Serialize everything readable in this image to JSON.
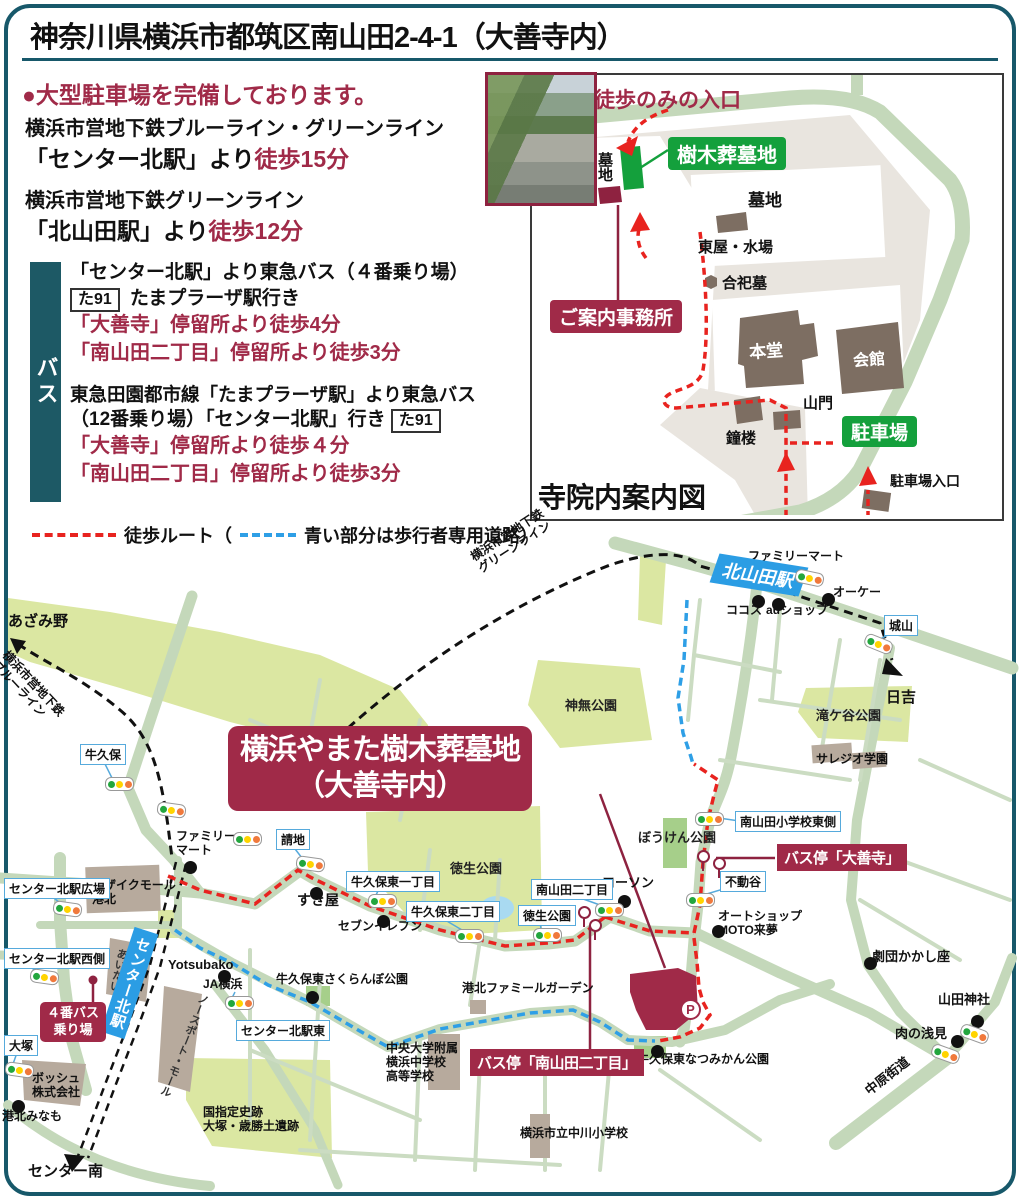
{
  "header": {
    "title": "神奈川県横浜市都筑区南山田2-4-1（大善寺内）"
  },
  "access": {
    "parking_note": "●大型駐車場を完備しております。",
    "subway1_line": "横浜市営地下鉄ブルーライン・グリーンライン",
    "subway1_from": "「センター北駅」より",
    "subway1_walk": "徒歩15分",
    "subway2_line": "横浜市営地下鉄グリーンライン",
    "subway2_from": "「北山田駅」より",
    "subway2_walk": "徒歩12分"
  },
  "bus": {
    "sidebar_label": "バス",
    "route1_line1": "「センター北駅」より東急バス（４番乗り場）",
    "route1_badge": "た91",
    "route1_dest": "たまプラーザ駅行き",
    "route1_stop1": "「大善寺」停留所より徒歩4分",
    "route1_stop2": "「南山田二丁目」停留所より徒歩3分",
    "route2_line1": "東急田園都市線「たまプラーザ駅」より東急バス",
    "route2_line2": "（12番乗り場）「センター北駅」行き",
    "route2_badge": "た91",
    "route2_stop1": "「大善寺」停留所より徒歩４分",
    "route2_stop2": "「南山田二丁目」停留所より徒歩3分"
  },
  "legend": {
    "walk_label": "徒歩ルート（",
    "blue_label": "青い部分は歩行者専用道路）"
  },
  "temple_map": {
    "title": "寺院内案内図",
    "entrance_label": "徒歩のみの入口",
    "tree_grave_badge": "樹木葬墓地",
    "grave_small": "墓地",
    "grave_large": "墓地",
    "azumaya": "東屋・水場",
    "goshibo": "合祀墓",
    "office_badge": "ご案内事務所",
    "hondo": "本堂",
    "kaikan": "会館",
    "sanmon": "山門",
    "shoro": "鐘楼",
    "parking_badge": "駐車場",
    "parking_entrance": "駐車場入口"
  },
  "map": {
    "badges": [
      {
        "t": "横浜やまた樹木葬墓地\n（大善寺内）",
        "x": 228,
        "y": 726,
        "cls": "badge-main"
      },
      {
        "t": "４番バス\n乗り場",
        "x": 40,
        "y": 1002,
        "cls": "badge-sm"
      },
      {
        "t": "バス停「大善寺」",
        "x": 777,
        "y": 844,
        "cls": "badge-bar"
      },
      {
        "t": "バス停「南山田二丁目」",
        "x": 470,
        "y": 1049,
        "cls": "badge-bar"
      }
    ],
    "stations": [
      {
        "t": "北山田駅",
        "x": 714,
        "y": 560,
        "kind": "h"
      },
      {
        "t": "センター北駅",
        "x": 117,
        "y": 928,
        "kind": "v"
      }
    ],
    "boxes": [
      {
        "t": "牛久保",
        "x": 80,
        "y": 744
      },
      {
        "t": "請地",
        "x": 276,
        "y": 829
      },
      {
        "t": "牛久保東一丁目",
        "x": 346,
        "y": 871
      },
      {
        "t": "牛久保東二丁目",
        "x": 406,
        "y": 901
      },
      {
        "t": "南山田二丁目",
        "x": 531,
        "y": 879
      },
      {
        "t": "徳生公園",
        "x": 518,
        "y": 905
      },
      {
        "t": "南山田小学校東側",
        "x": 735,
        "y": 811
      },
      {
        "t": "不動谷",
        "x": 720,
        "y": 871
      },
      {
        "t": "センター北駅広場",
        "x": 4,
        "y": 878
      },
      {
        "t": "センター北駅西側",
        "x": 4,
        "y": 948
      },
      {
        "t": "センター北駅東",
        "x": 236,
        "y": 1020
      },
      {
        "t": "大塚",
        "x": 4,
        "y": 1035
      },
      {
        "t": "城山",
        "x": 884,
        "y": 615
      }
    ],
    "pois": [
      {
        "t": "ファミリーマート",
        "x": 748,
        "y": 550
      },
      {
        "t": "オーケー",
        "x": 833,
        "y": 586
      },
      {
        "t": "ココス",
        "x": 726,
        "y": 604
      },
      {
        "t": "auショップ",
        "x": 766,
        "y": 604
      },
      {
        "t": "ファミリー\nマート",
        "x": 176,
        "y": 830
      },
      {
        "t": "すき屋",
        "x": 297,
        "y": 892,
        "fs": 14
      },
      {
        "t": "セブンイレブン",
        "x": 338,
        "y": 920
      },
      {
        "t": "ローソン",
        "x": 602,
        "y": 876,
        "fs": 13
      },
      {
        "t": "Yotsubako",
        "x": 168,
        "y": 958,
        "fs": 13
      },
      {
        "t": "JA横浜",
        "x": 203,
        "y": 978
      },
      {
        "t": "オートショップ\nMOTO来夢",
        "x": 718,
        "y": 910
      },
      {
        "t": "劇団かかし座",
        "x": 872,
        "y": 950,
        "fs": 13
      },
      {
        "t": "山田神社",
        "x": 938,
        "y": 993,
        "fs": 13
      },
      {
        "t": "肉の浅見",
        "x": 895,
        "y": 1027,
        "fs": 13
      },
      {
        "t": "港北みなも",
        "x": 2,
        "y": 1110
      },
      {
        "t": "牛久保東さくらんぼ公園",
        "x": 276,
        "y": 973
      },
      {
        "t": "牛久保東なつみかん公園",
        "x": 637,
        "y": 1053
      },
      {
        "t": "港北ファミールガーデン",
        "x": 462,
        "y": 982
      },
      {
        "t": "横浜市立中川小学校",
        "x": 520,
        "y": 1127
      },
      {
        "t": "中央大学附属\n横浜中学校\n高等学校",
        "x": 386,
        "y": 1042
      },
      {
        "t": "モザイクモール\n港北",
        "x": 92,
        "y": 879
      },
      {
        "t": "ボッシュ\n株式会社",
        "x": 32,
        "y": 1072
      },
      {
        "t": "国指定史跡\n大塚・歳勝土遺跡",
        "x": 203,
        "y": 1106
      },
      {
        "t": "サレジオ学園",
        "x": 816,
        "y": 753
      }
    ],
    "area_labels": [
      {
        "t": "神無公園",
        "x": 565,
        "y": 695
      },
      {
        "t": "滝ケ谷公園",
        "x": 816,
        "y": 705
      },
      {
        "t": "徳生公園",
        "x": 450,
        "y": 858
      },
      {
        "t": "ぼうけん公園",
        "x": 638,
        "y": 827
      }
    ],
    "edges": [
      {
        "t": "あざみ野",
        "x": 8,
        "y": 610
      },
      {
        "t": "日吉",
        "x": 886,
        "y": 686
      },
      {
        "t": "センター南",
        "x": 28,
        "y": 1160
      }
    ],
    "rail_labels": [
      {
        "t": "横浜市営地下鉄\nグリーンライン",
        "x": 468,
        "y": 552,
        "rot": -33
      },
      {
        "t": "横浜市営地下鉄\nブルーライン",
        "x": 10,
        "y": 648,
        "rot": 47
      },
      {
        "t": "中原街道",
        "x": 862,
        "y": 1086,
        "rot": -38,
        "fs": 13
      }
    ],
    "rot_labels": [
      {
        "t": "あいたい",
        "x": 110,
        "y": 948,
        "rot": 12
      },
      {
        "t": "ノースポート・モール",
        "x": 176,
        "y": 990,
        "rot": 22
      }
    ],
    "dots": [
      [
        762,
        571
      ],
      [
        822,
        593
      ],
      [
        752,
        595
      ],
      [
        772,
        598
      ],
      [
        184,
        861
      ],
      [
        310,
        887
      ],
      [
        377,
        915
      ],
      [
        618,
        895
      ],
      [
        218,
        970
      ],
      [
        712,
        925
      ],
      [
        864,
        957
      ],
      [
        971,
        1015
      ],
      [
        951,
        1035
      ],
      [
        12,
        1100
      ],
      [
        306,
        991
      ],
      [
        651,
        1045
      ]
    ],
    "traffic_lights": [
      [
        795,
        571,
        12
      ],
      [
        864,
        637,
        22
      ],
      [
        105,
        777,
        0
      ],
      [
        157,
        803,
        8
      ],
      [
        233,
        832,
        0
      ],
      [
        296,
        857,
        8
      ],
      [
        368,
        894,
        0
      ],
      [
        455,
        929,
        0
      ],
      [
        595,
        903,
        0
      ],
      [
        533,
        928,
        0
      ],
      [
        695,
        812,
        0
      ],
      [
        686,
        893,
        0
      ],
      [
        53,
        902,
        8
      ],
      [
        30,
        970,
        8
      ],
      [
        5,
        1063,
        8
      ],
      [
        225,
        996,
        0
      ],
      [
        960,
        1027,
        20
      ],
      [
        931,
        1047,
        20
      ]
    ],
    "bus_poles": [
      [
        578,
        906
      ],
      [
        589,
        919
      ],
      [
        697,
        850
      ],
      [
        713,
        857
      ]
    ],
    "parking_icon": {
      "t": "P",
      "x": 680,
      "y": 999
    }
  },
  "colors": {
    "frame_teal": "#17586a",
    "crimson": "#a02a48",
    "route_red": "#e8231f",
    "route_blue": "#2e9fe6",
    "road_green": "#c4d8ba",
    "park_green": "#dbe7a2",
    "badge_green": "#14a03c",
    "station_blue": "#2b9de4"
  }
}
